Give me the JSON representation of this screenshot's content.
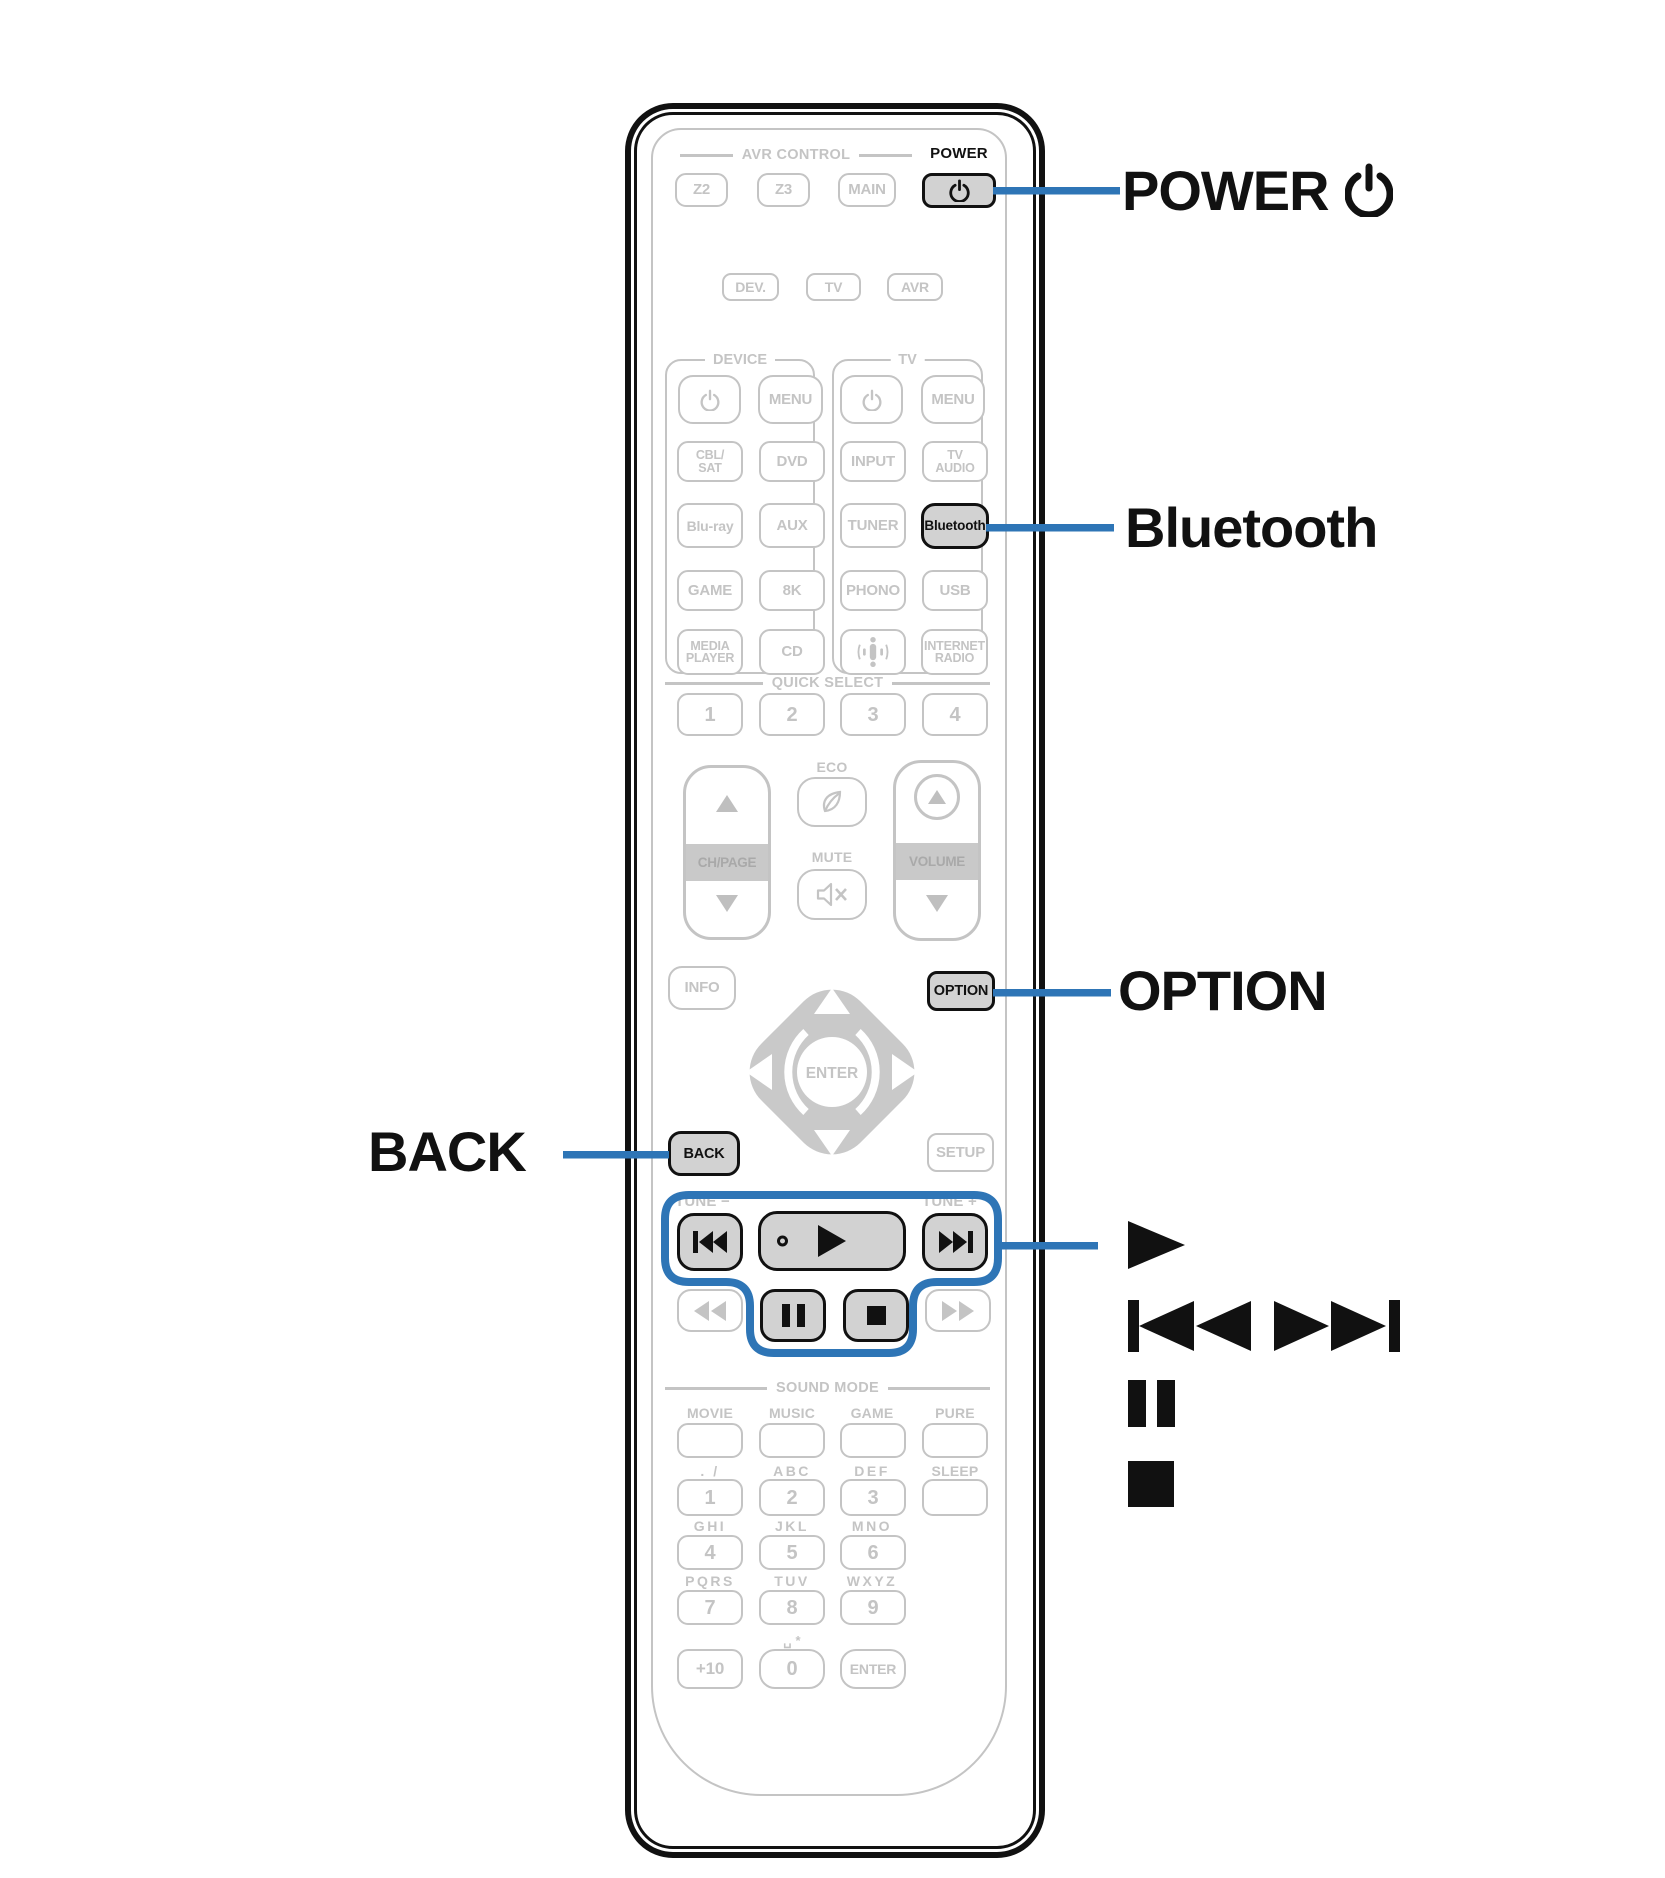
{
  "colors": {
    "accent_blue": "#2E75B6",
    "highlight_button_fill": "#d2d2d2",
    "faded_gray": "#c4c4c4",
    "ink_black": "#111111"
  },
  "callouts": {
    "power": "POWER",
    "bluetooth": "Bluetooth",
    "option": "OPTION",
    "back": "BACK"
  },
  "remote": {
    "avr_header": "AVR CONTROL",
    "z2": "Z2",
    "z3": "Z3",
    "main": "MAIN",
    "power_small": "POWER",
    "dev": "DEV.",
    "tv": "TV",
    "avr": "AVR",
    "device_header": "DEVICE",
    "tv_header": "TV",
    "menu1": "MENU",
    "menu2": "MENU",
    "cbl_sat": "CBL/\nSAT",
    "dvd": "DVD",
    "input": "INPUT",
    "tv_audio": "TV\nAUDIO",
    "bluray": "Blu-ray",
    "aux": "AUX",
    "tuner": "TUNER",
    "bluetooth": "Bluetooth",
    "game": "GAME",
    "8k": "8K",
    "phono": "PHONO",
    "usb": "USB",
    "media_player": "MEDIA\nPLAYER",
    "cd": "CD",
    "internet_radio": "INTERNET\nRADIO",
    "quick_select_header": "QUICK SELECT",
    "qs1": "1",
    "qs2": "2",
    "qs3": "3",
    "qs4": "4",
    "eco": "ECO",
    "ch_page": "CH/PAGE",
    "mute": "MUTE",
    "volume": "VOLUME",
    "info": "INFO",
    "option": "OPTION",
    "enter_pad": "ENTER",
    "back": "BACK",
    "setup": "SETUP",
    "tune_minus": "TUNE −",
    "tune_plus": "TUNE +",
    "sound_mode_header": "SOUND MODE",
    "movie": "MOVIE",
    "music": "MUSIC",
    "game_sm": "GAME",
    "pure": "PURE",
    "sub_1": ". /",
    "sub_2": "ABC",
    "sub_3": "DEF",
    "sleep": "SLEEP",
    "d1": "1",
    "d2": "2",
    "d3": "3",
    "sub_4": "GHI",
    "sub_5": "JKL",
    "sub_6": "MNO",
    "d4": "4",
    "d5": "5",
    "d6": "6",
    "sub_7": "PQRS",
    "sub_8": "TUV",
    "sub_9": "WXYZ",
    "d7": "7",
    "d8": "8",
    "d9": "9",
    "zero_sub": "␣ *",
    "plus10": "+10",
    "d0": "0",
    "enter_btn": "ENTER"
  }
}
